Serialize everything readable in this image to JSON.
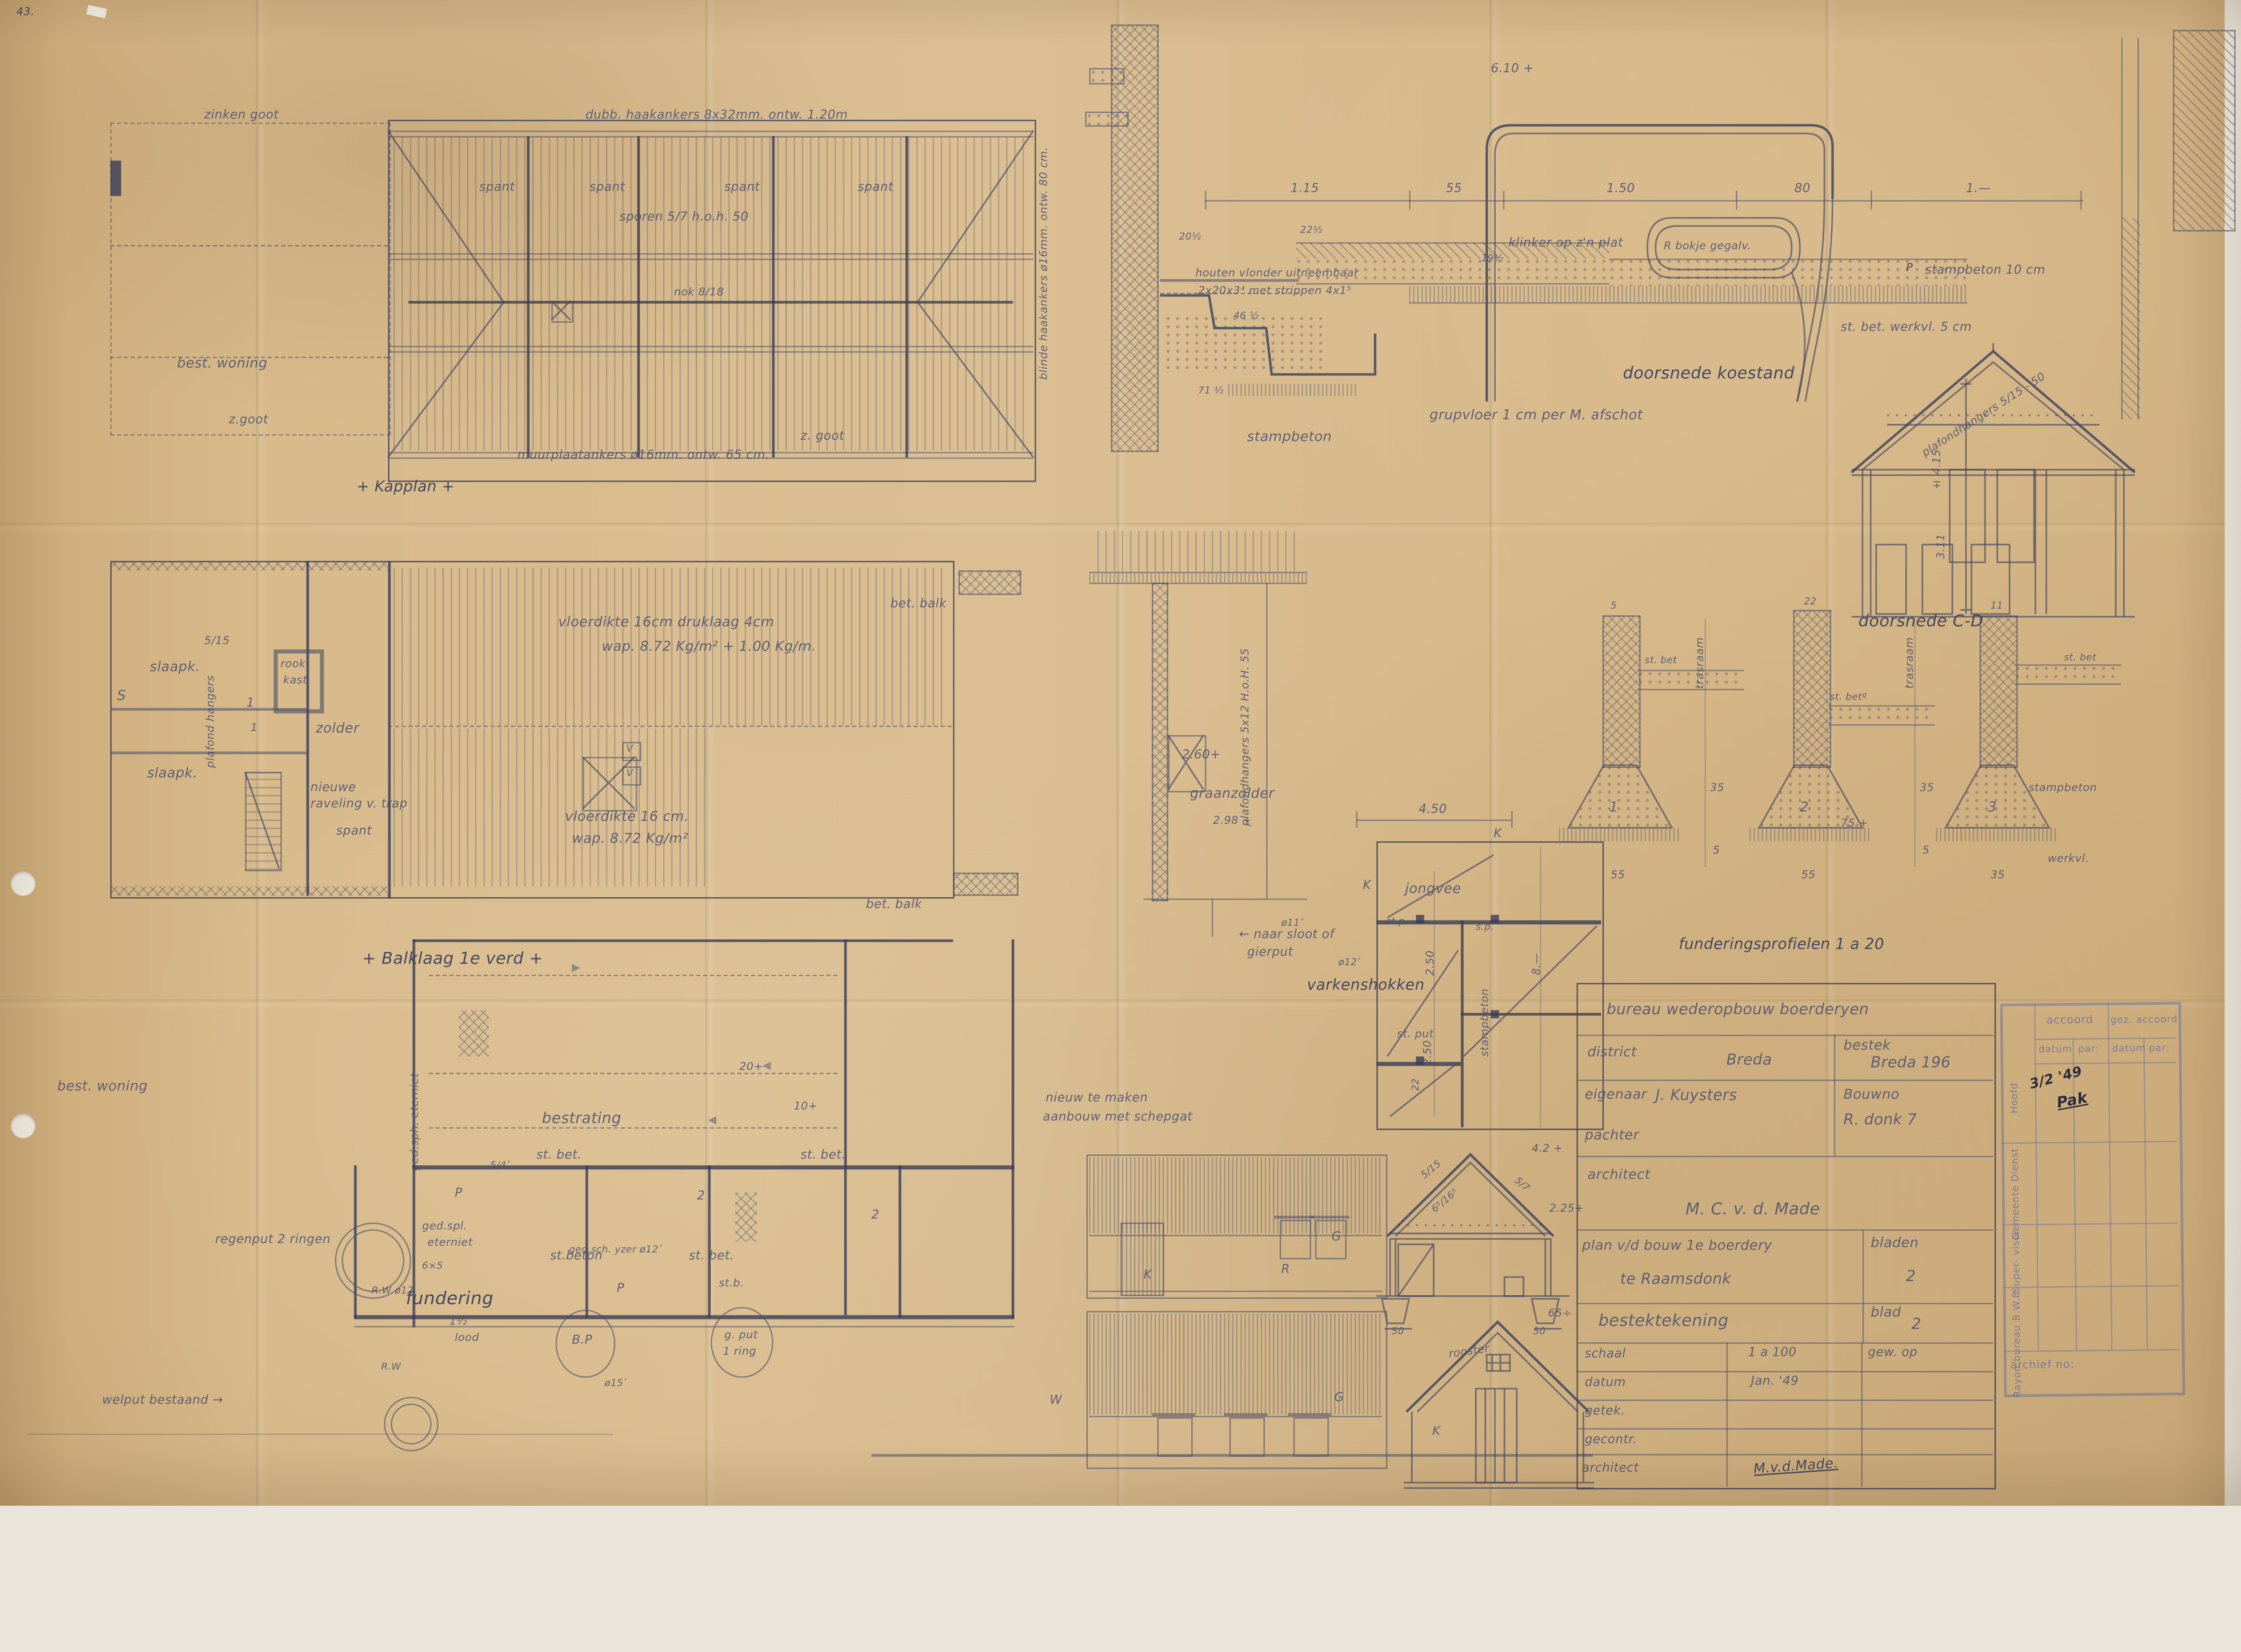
{
  "page": {
    "corner_mark": "43."
  },
  "kapplan": {
    "caption": "+ Kapplan +",
    "zinken_goot": "zinken goot",
    "haakankers_top": "dubb. haakankers 8x32mm. ontw. 1.20m",
    "spant1": "spant",
    "spant2": "spant",
    "spant3": "spant",
    "spant4": "spant",
    "sporen": "sporen 5/7  h.o.h. 50",
    "nok": "nok 8/18",
    "best_woning": "best. woning",
    "z_goot_1": "z.goot",
    "z_goot_2": "z. goot",
    "muurplaatankers": "muurplaatankers ø16mm. ontw. 65 cm.",
    "haakankers_right": "blinde haakankers ø16mm. ontw. 80 cm."
  },
  "koestand": {
    "caption": "doorsnede koestand",
    "level_top": "6.10 +",
    "bokje": "R bokje gegalv.",
    "dim1": "1.15",
    "dim2": "55",
    "dim3": "1.50",
    "dim4": "80",
    "dim5": "1.—",
    "vlonder1": "houten vlonder uitneembaar",
    "vlonder2": "2x20x3⁴ met strippen 4x1⁵",
    "klinker": "klinker op z'n plat",
    "klinker_dim": "19½",
    "grupvloer": "grupvloer 1 cm per M. afschot",
    "stampbeton": "stampbeton",
    "stampbeton10": "stampbeton 10 cm",
    "p_mark": "P",
    "werkvloer": "st. bet. werkvl. 5 cm",
    "d20": "20½",
    "d22": "22½",
    "d46": "46 ½",
    "d71": "71 ½"
  },
  "cd": {
    "caption": "doorsnede C-D",
    "plafondhangers": "plafondhangers 5/15 - 50",
    "dim415": "± 4.15",
    "dim311": "3.11"
  },
  "profielen": {
    "caption": "funderingsprofielen 1 a 20",
    "trasraam1": "trasraam",
    "trasraam2": "trasraam",
    "stbet1": "st. bet",
    "stbet2": "st. betº",
    "stbet3": "st. bet",
    "stampbeton": "stampbeton",
    "werkvl": "werkvl.",
    "n1": "1",
    "n2": "2",
    "n3": "3",
    "w1": "55",
    "w2": "55",
    "w3": "35",
    "d35a": "35",
    "d35b": "35",
    "d5a": "5",
    "d5b": "5",
    "d75": "75 +",
    "t5": "5",
    "t22": "22",
    "t11": "11"
  },
  "balklaag": {
    "caption": "+ Balklaag 1e verd +",
    "slaapk1": "slaapk.",
    "slaapk2": "slaapk.",
    "dim515": "5/15",
    "plafond_vert": "plafond hangers",
    "rookkast1": "rook",
    "rookkast2": "kast",
    "zolder": "zolder",
    "raveling1": "nieuwe",
    "raveling2": "raveling v. trap",
    "spant": "spant",
    "s": "S",
    "one1": "1",
    "one2": "1",
    "vloer1a": "vloerdikte 16cm druklaag 4cm",
    "vloer1b": "wap. 8.72 Kg/m² + 1.00 Kg/m.",
    "vloer2a": "vloerdikte 16 cm.",
    "vloer2b": "wap.  8.72 Kg/m²",
    "betbalk1": "bet. balk",
    "betbalk2": "bet. balk",
    "v1": "V",
    "v2": "V"
  },
  "wallsec": {
    "plafondhangers": "plafondhangers 5x12 H.o.H. 55",
    "lvl260": "2.60+",
    "graanzolder": "graanzolder",
    "lvl298": "2.98 +",
    "sloot1": "← naar sloot of",
    "sloot2": "gierput",
    "d11": "ø11ʹ",
    "d12": "ø12ʹ"
  },
  "varkens": {
    "caption": "varkenshokken",
    "jongvee": "jongvee",
    "d450": "4.50",
    "d250a": "2.50",
    "d250b": "2.50",
    "d8": "8.—",
    "d22": "22",
    "stampbeton": "stampbeton",
    "stp": "st.p",
    "sp": "s.p.",
    "stput": "st. put",
    "k1": "K",
    "k2": "K"
  },
  "fundering": {
    "caption": "fundering",
    "best_woning": "best. woning",
    "bestrating": "bestrating",
    "stbet1": "st. bet.",
    "stbet2": "st. bet.",
    "stbet3": "st.beton",
    "stbet4": "st. bet.",
    "stb": "st.b.",
    "eterniet_v": "ged.sph. eterniet",
    "eterniet1": "ged.spl.",
    "eterniet2": "eterniet",
    "lood1": "1½″",
    "lood2": "lood",
    "regenput": "regenput 2 ringen",
    "bp": "B.P",
    "gput1": "g. put",
    "gput2": "1 ring",
    "welput": "welput bestaand →",
    "rw1": "R.W ø12",
    "rw2": "R.W",
    "d20": "20+",
    "d10": "10+",
    "p1": "P",
    "p2": "P",
    "n2a": "2",
    "n2b": "2",
    "d54": "5/4ʹ",
    "d65": "6×5",
    "yzer": "ged.sch. yzer ø12ʹ",
    "d15": "ø15ʹ",
    "arr1": "▶",
    "arr2": "◀",
    "arr3": "◀",
    "nieuw1": "nieuw te maken",
    "nieuw2": "aanbouw met schepgat"
  },
  "gevels": {
    "k1": "K",
    "r": "R",
    "g1": "G",
    "g2": "G",
    "w": "W",
    "k2": "K",
    "rooster": "rooster",
    "d515": "5/15",
    "d57": "5/7",
    "d6165": "6⁵/16⁵",
    "lvl42": "4.2 +",
    "lvl225": "2.25+",
    "lvl65": "65÷",
    "w50a": "50",
    "w50b": "50"
  },
  "titleblock": {
    "bureau": "bureau wederopbouw boerderyen",
    "district_label": "district",
    "district_value": "Breda",
    "bestek_label": "bestek",
    "bestek_value": "Breda   196",
    "eigenaar_label": "eigenaar",
    "eigenaar_value": "J. Kuysters",
    "pachter_label": "pachter",
    "bouwno_label": "Bouwno",
    "bouwno_value": "R. donk      7",
    "architect_label": "architect",
    "architect_value": "M. C. v. d. Made",
    "plan1": "plan v/d bouw 1e boerdery",
    "plan2": "te Raamsdonk",
    "bladen_label": "bladen",
    "bladen_value": "2",
    "bestektekening": "bestektekening",
    "blad_label": "blad",
    "blad_value": "2",
    "schaal_label": "schaal",
    "schaal_value": "1 a 100",
    "gew_op": "gew. op",
    "datum_label": "datum",
    "datum_value": "Jan. '49",
    "getek_label": "getek.",
    "gecontr_label": "gecontr.",
    "architect2_label": "architect",
    "signature": "M.v.d.Made.",
    "note_date": "3/2 '49",
    "note_sign": "Pak"
  },
  "stamp": {
    "accoord1": "accoord",
    "accoord2": "gez. accoord",
    "datum1": "datum",
    "par1": "par:",
    "datum2": "datum",
    "par2": "par:",
    "row1": "Hoofd",
    "row2": "Gemeente Dienst",
    "row3": "Super- visor",
    "row4": "Rayon bureau B.W.B",
    "archief": "archief no:"
  }
}
